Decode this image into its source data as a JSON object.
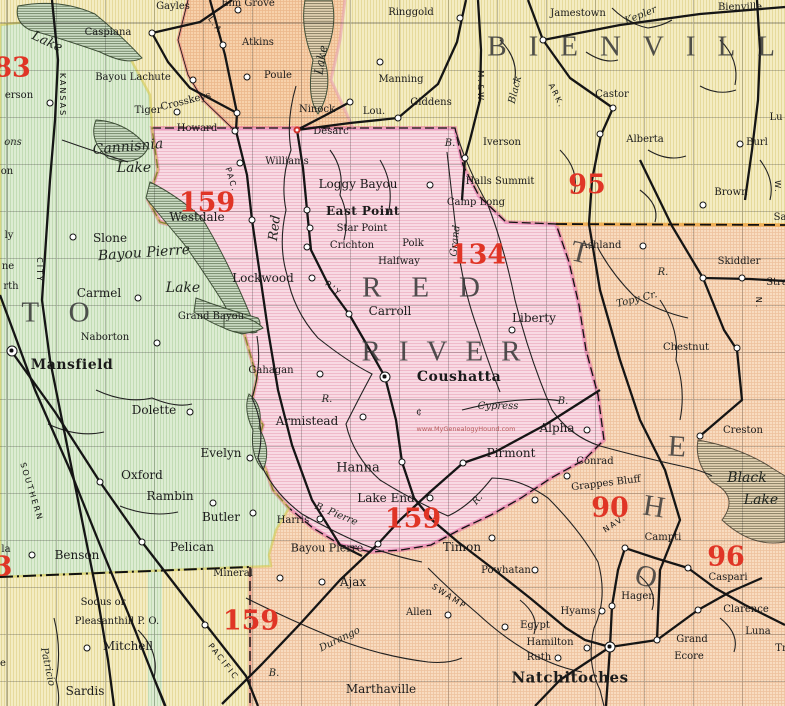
{
  "page": {
    "title": "Red River Parish, Louisiana, 1911, Map"
  },
  "map": {
    "watermark": "www.MyGenealogyHound.com",
    "regions": [
      {
        "id": "west-green",
        "fill": "#dcecd2"
      },
      {
        "id": "center-pink",
        "fill": "#f8dae3"
      },
      {
        "id": "northeast-yellow",
        "fill": "#f4ecc2"
      },
      {
        "id": "southeast-orange",
        "fill": "#f8dcc0"
      },
      {
        "id": "topcenter-orange",
        "fill": "#f7d2ac"
      },
      {
        "id": "topleft-yellow",
        "fill": "#f6eec6"
      },
      {
        "id": "bottomleft-yellow",
        "fill": "#f5ecc0"
      }
    ],
    "accent": {
      "red_numbers": "#e03526",
      "boundary_pink": "#e0559b",
      "boundary_orange": "#eda43e"
    },
    "labels": [
      {
        "t": "Gayles",
        "x": 173,
        "y": 7
      },
      {
        "t": "Caspiana",
        "x": 108,
        "y": 33
      },
      {
        "t": "Bayou Lachute",
        "x": 133,
        "y": 78
      },
      {
        "t": "Tiger",
        "x": 148,
        "y": 111
      },
      {
        "t": "Crosskeys",
        "x": 186,
        "y": 102,
        "r": -14
      },
      {
        "t": "Howard",
        "x": 197,
        "y": 129
      },
      {
        "t": "Elm Grove",
        "x": 248,
        "y": 4
      },
      {
        "t": "Atkins",
        "x": 258,
        "y": 43
      },
      {
        "t": "Poule",
        "x": 278,
        "y": 76
      },
      {
        "t": "Ninock",
        "x": 317,
        "y": 110
      },
      {
        "t": "Lou.",
        "x": 374,
        "y": 112
      },
      {
        "t": "Desarc",
        "x": 331,
        "y": 132
      },
      {
        "t": "Manning",
        "x": 401,
        "y": 80
      },
      {
        "t": "Giddens",
        "x": 431,
        "y": 103
      },
      {
        "t": "Ringgold",
        "x": 411,
        "y": 13
      },
      {
        "t": "Jamestown",
        "x": 578,
        "y": 14
      },
      {
        "t": "Kepler",
        "x": 641,
        "y": 16,
        "c": "wat",
        "r": -22
      },
      {
        "t": "Bienville",
        "x": 740,
        "y": 8
      },
      {
        "t": "BIENVILLE",
        "x": 662,
        "y": 47,
        "c": "big",
        "ls": 22
      },
      {
        "t": "Castor",
        "x": 612,
        "y": 95
      },
      {
        "t": "Alberta",
        "x": 645,
        "y": 140
      },
      {
        "t": "Iverson",
        "x": 502,
        "y": 143
      },
      {
        "t": "Brown",
        "x": 731,
        "y": 193
      },
      {
        "t": "Burl",
        "x": 757,
        "y": 143
      },
      {
        "t": "Lu",
        "x": 776,
        "y": 118
      },
      {
        "t": "Sa",
        "x": 780,
        "y": 218
      },
      {
        "t": "W.",
        "x": 777,
        "y": 187,
        "c": "rr",
        "r": 90
      },
      {
        "t": "95",
        "x": 587,
        "y": 185,
        "c": "num"
      },
      {
        "t": "Halls Summit",
        "x": 500,
        "y": 182
      },
      {
        "t": "Camp Long",
        "x": 476,
        "y": 203
      },
      {
        "t": "Williams",
        "x": 287,
        "y": 162
      },
      {
        "t": "Loggy Bayou",
        "x": 358,
        "y": 184,
        "fs": 12
      },
      {
        "t": "East Point",
        "x": 363,
        "y": 211,
        "c": "tb",
        "fs": 12
      },
      {
        "t": "Star Point",
        "x": 362,
        "y": 229
      },
      {
        "t": "Crichton",
        "x": 352,
        "y": 246
      },
      {
        "t": "Polk",
        "x": 413,
        "y": 244
      },
      {
        "t": "Halfway",
        "x": 399,
        "y": 262
      },
      {
        "t": "Westdale",
        "x": 197,
        "y": 217,
        "fs": 12
      },
      {
        "t": "159",
        "x": 207,
        "y": 203,
        "c": "num"
      },
      {
        "t": "134",
        "x": 478,
        "y": 255,
        "c": "num"
      },
      {
        "t": "Lockwood",
        "x": 263,
        "y": 278,
        "fs": 12
      },
      {
        "t": "Carroll",
        "x": 390,
        "y": 311,
        "fs": 12
      },
      {
        "t": "Liberty",
        "x": 534,
        "y": 318,
        "fs": 12
      },
      {
        "t": "RED",
        "x": 436,
        "y": 288,
        "c": "big",
        "ls": 30
      },
      {
        "t": "RIVER",
        "x": 450,
        "y": 352,
        "c": "big",
        "ls": 18
      },
      {
        "t": "Coushatta",
        "x": 459,
        "y": 377,
        "c": "tb",
        "fs": 14
      },
      {
        "t": "Gahagan",
        "x": 271,
        "y": 371
      },
      {
        "t": "R.",
        "x": 327,
        "y": 400,
        "c": "wat"
      },
      {
        "t": "Armistead",
        "x": 307,
        "y": 421,
        "fs": 12
      },
      {
        "t": "¢",
        "x": 419,
        "y": 413,
        "c": "ts"
      },
      {
        "t": "www.MyGenealogyHound.com",
        "x": 466,
        "y": 429,
        "c": "wm"
      },
      {
        "t": "Cypress",
        "x": 498,
        "y": 407,
        "c": "wat"
      },
      {
        "t": "B.",
        "x": 563,
        "y": 402,
        "c": "wat"
      },
      {
        "t": "Alpha",
        "x": 557,
        "y": 428,
        "fs": 12
      },
      {
        "t": "Hanna",
        "x": 358,
        "y": 468,
        "fs": 13
      },
      {
        "t": "Lake End",
        "x": 386,
        "y": 498,
        "fs": 12
      },
      {
        "t": "159",
        "x": 413,
        "y": 519,
        "c": "num"
      },
      {
        "t": "Pirmont",
        "x": 511,
        "y": 453,
        "fs": 12
      },
      {
        "t": "R.",
        "x": 478,
        "y": 500,
        "c": "wat",
        "r": -50
      },
      {
        "t": "Harris",
        "x": 293,
        "y": 521
      },
      {
        "t": "B. Pierre",
        "x": 336,
        "y": 515,
        "c": "wat",
        "r": 22
      },
      {
        "t": "Bayou Pierre",
        "x": 327,
        "y": 548,
        "fs": 11
      },
      {
        "t": "Timon",
        "x": 462,
        "y": 547,
        "fs": 12
      },
      {
        "t": "Powhatan",
        "x": 506,
        "y": 571
      },
      {
        "t": "Ajax",
        "x": 353,
        "y": 582,
        "fs": 12
      },
      {
        "t": "Allen",
        "x": 419,
        "y": 613
      },
      {
        "t": "SWAMP",
        "x": 449,
        "y": 597,
        "c": "rr",
        "r": 33
      },
      {
        "t": "Durango",
        "x": 340,
        "y": 640,
        "c": "wat",
        "r": -26
      },
      {
        "t": "Marthaville",
        "x": 381,
        "y": 689,
        "fs": 12
      },
      {
        "t": "Ashland",
        "x": 601,
        "y": 246
      },
      {
        "t": "Skiddler",
        "x": 739,
        "y": 262
      },
      {
        "t": "Stra",
        "x": 777,
        "y": 283
      },
      {
        "t": "R.",
        "x": 663,
        "y": 273,
        "c": "wat"
      },
      {
        "t": "Topy Cr.",
        "x": 637,
        "y": 300,
        "c": "wat",
        "r": -14
      },
      {
        "t": "Chestnut",
        "x": 686,
        "y": 348
      },
      {
        "t": "N.",
        "x": 758,
        "y": 303,
        "c": "rr",
        "r": 90
      },
      {
        "t": "Creston",
        "x": 743,
        "y": 431
      },
      {
        "t": "Black",
        "x": 747,
        "y": 478,
        "c": "watl"
      },
      {
        "t": "Lake",
        "x": 761,
        "y": 500,
        "c": "watl"
      },
      {
        "t": "Conrad",
        "x": 595,
        "y": 462
      },
      {
        "t": "Grappes Bluff",
        "x": 606,
        "y": 484,
        "r": -7
      },
      {
        "t": "90",
        "x": 610,
        "y": 508,
        "c": "num"
      },
      {
        "t": "NAV.",
        "x": 615,
        "y": 524,
        "c": "rr",
        "r": -33
      },
      {
        "t": "Campti",
        "x": 663,
        "y": 538
      },
      {
        "t": "96",
        "x": 726,
        "y": 557,
        "c": "num"
      },
      {
        "t": "Caspari",
        "x": 728,
        "y": 578
      },
      {
        "t": "Hagen",
        "x": 638,
        "y": 597
      },
      {
        "t": "Hyams",
        "x": 578,
        "y": 612
      },
      {
        "t": "Egypt",
        "x": 535,
        "y": 626
      },
      {
        "t": "Hamilton",
        "x": 550,
        "y": 643
      },
      {
        "t": "Ruth",
        "x": 539,
        "y": 658
      },
      {
        "t": "Natchitoches",
        "x": 570,
        "y": 678,
        "c": "tb",
        "fs": 15
      },
      {
        "t": "Clarence",
        "x": 746,
        "y": 610
      },
      {
        "t": "Luna",
        "x": 758,
        "y": 632
      },
      {
        "t": "Grand",
        "x": 692,
        "y": 640
      },
      {
        "t": "Ecore",
        "x": 689,
        "y": 657
      },
      {
        "t": "Tr",
        "x": 781,
        "y": 649
      },
      {
        "t": "T",
        "x": 580,
        "y": 253,
        "c": "bigl",
        "r": 14
      },
      {
        "t": "E",
        "x": 677,
        "y": 447,
        "c": "bigl",
        "r": 4
      },
      {
        "t": "H",
        "x": 654,
        "y": 507,
        "c": "bigl",
        "r": 9
      },
      {
        "t": "O",
        "x": 646,
        "y": 577,
        "c": "bigl",
        "r": 14
      },
      {
        "t": "Lake",
        "x": 47,
        "y": 42,
        "c": "wat",
        "r": 25,
        "fs": 13
      },
      {
        "t": "83",
        "x": 12,
        "y": 68,
        "c": "num"
      },
      {
        "t": "erson",
        "x": 19,
        "y": 96
      },
      {
        "t": "KANSAS",
        "x": 62,
        "y": 95,
        "c": "rr",
        "r": 90
      },
      {
        "t": "ons",
        "x": 13,
        "y": 143,
        "c": "wat"
      },
      {
        "t": "Cannisnia",
        "x": 128,
        "y": 147,
        "c": "watl",
        "r": -5
      },
      {
        "t": "Lake",
        "x": 134,
        "y": 168,
        "c": "watl"
      },
      {
        "t": "on",
        "x": 7,
        "y": 172
      },
      {
        "t": "ly",
        "x": 9,
        "y": 236
      },
      {
        "t": "ne",
        "x": 8,
        "y": 267
      },
      {
        "t": "rth",
        "x": 11,
        "y": 287
      },
      {
        "t": "CITY",
        "x": 39,
        "y": 270,
        "c": "rr",
        "r": 90
      },
      {
        "t": "Slone",
        "x": 110,
        "y": 238,
        "fs": 12
      },
      {
        "t": "Bayou Pierre",
        "x": 144,
        "y": 253,
        "c": "watl",
        "r": -4
      },
      {
        "t": "Lake",
        "x": 183,
        "y": 288,
        "c": "watl"
      },
      {
        "t": "Carmel",
        "x": 99,
        "y": 293,
        "fs": 12
      },
      {
        "t": "OTO",
        "x": 45,
        "y": 313,
        "c": "big",
        "ls": 30
      },
      {
        "t": "Grand Bayou",
        "x": 211,
        "y": 317
      },
      {
        "t": "Naborton",
        "x": 105,
        "y": 338
      },
      {
        "t": "Mansfield",
        "x": 72,
        "y": 365,
        "c": "tb",
        "fs": 14
      },
      {
        "t": "Dolette",
        "x": 154,
        "y": 410,
        "fs": 12
      },
      {
        "t": "SOUTHERN",
        "x": 31,
        "y": 492,
        "c": "rr",
        "r": 73
      },
      {
        "t": "Evelyn",
        "x": 221,
        "y": 453,
        "fs": 12
      },
      {
        "t": "Oxford",
        "x": 142,
        "y": 475,
        "fs": 12
      },
      {
        "t": "Rambin",
        "x": 170,
        "y": 496,
        "fs": 12
      },
      {
        "t": "Butler",
        "x": 221,
        "y": 517,
        "fs": 12
      },
      {
        "t": "Pelican",
        "x": 192,
        "y": 547,
        "fs": 12
      },
      {
        "t": "Benson",
        "x": 77,
        "y": 555,
        "fs": 12
      },
      {
        "t": "Mineral",
        "x": 233,
        "y": 574
      },
      {
        "t": "la",
        "x": 6,
        "y": 550
      },
      {
        "t": "3",
        "x": 3,
        "y": 567,
        "c": "num"
      },
      {
        "t": "Sodus or",
        "x": 103,
        "y": 603
      },
      {
        "t": "Pleasanthill P. O.",
        "x": 117,
        "y": 622
      },
      {
        "t": "159",
        "x": 251,
        "y": 621,
        "c": "num"
      },
      {
        "t": "Mitchell",
        "x": 128,
        "y": 646,
        "fs": 12
      },
      {
        "t": "Patricio",
        "x": 47,
        "y": 667,
        "c": "wat",
        "r": 78
      },
      {
        "t": "Sardis",
        "x": 85,
        "y": 691,
        "fs": 12
      },
      {
        "t": "e",
        "x": 3,
        "y": 664
      },
      {
        "t": "PACIFIC",
        "x": 223,
        "y": 662,
        "c": "rr",
        "r": 52
      },
      {
        "t": "B.",
        "x": 274,
        "y": 674,
        "c": "wat"
      },
      {
        "t": "PAC.",
        "x": 231,
        "y": 180,
        "c": "rr",
        "r": 73
      },
      {
        "t": "R'Y",
        "x": 333,
        "y": 289,
        "c": "rr",
        "r": 40
      },
      {
        "t": "Red",
        "x": 275,
        "y": 228,
        "c": "wat",
        "r": -83,
        "fs": 13
      },
      {
        "t": "Lake",
        "x": 321,
        "y": 60,
        "c": "wat",
        "r": -80,
        "fs": 12
      },
      {
        "t": "L.A.",
        "x": 216,
        "y": 27,
        "c": "rr",
        "r": 55
      },
      {
        "t": "Black",
        "x": 516,
        "y": 90,
        "c": "wat",
        "r": -76
      },
      {
        "t": "B.",
        "x": 450,
        "y": 144,
        "c": "wat"
      },
      {
        "t": "ARK.",
        "x": 556,
        "y": 96,
        "c": "rr",
        "r": 64
      },
      {
        "t": "M.&W.",
        "x": 480,
        "y": 88,
        "c": "rr",
        "r": 90
      },
      {
        "t": "Grand",
        "x": 456,
        "y": 241,
        "c": "wat",
        "r": -84
      }
    ],
    "dots": [
      [
        238,
        10
      ],
      [
        152,
        33
      ],
      [
        223,
        45
      ],
      [
        247,
        77
      ],
      [
        193,
        80
      ],
      [
        177,
        112
      ],
      [
        237,
        113
      ],
      [
        235,
        131
      ],
      [
        350,
        102
      ],
      [
        380,
        62
      ],
      [
        398,
        118
      ],
      [
        460,
        18
      ],
      [
        543,
        40
      ],
      [
        613,
        108
      ],
      [
        600,
        134
      ],
      [
        465,
        158
      ],
      [
        703,
        205
      ],
      [
        740,
        144
      ],
      [
        297,
        130,
        "r"
      ],
      [
        240,
        163
      ],
      [
        252,
        220
      ],
      [
        307,
        210
      ],
      [
        310,
        228
      ],
      [
        307,
        247
      ],
      [
        430,
        185
      ],
      [
        312,
        278
      ],
      [
        349,
        314
      ],
      [
        512,
        330
      ],
      [
        385,
        377,
        "s"
      ],
      [
        320,
        374
      ],
      [
        363,
        417
      ],
      [
        587,
        430
      ],
      [
        643,
        246
      ],
      [
        703,
        278
      ],
      [
        742,
        278
      ],
      [
        737,
        348
      ],
      [
        700,
        436
      ],
      [
        567,
        476
      ],
      [
        535,
        500
      ],
      [
        463,
        463
      ],
      [
        402,
        462
      ],
      [
        430,
        498
      ],
      [
        320,
        519
      ],
      [
        378,
        544
      ],
      [
        492,
        538
      ],
      [
        535,
        570
      ],
      [
        322,
        582
      ],
      [
        448,
        615
      ],
      [
        280,
        578
      ],
      [
        50,
        103
      ],
      [
        12,
        351,
        "s"
      ],
      [
        73,
        237
      ],
      [
        138,
        298
      ],
      [
        157,
        343
      ],
      [
        190,
        412
      ],
      [
        250,
        458
      ],
      [
        100,
        482
      ],
      [
        213,
        503
      ],
      [
        253,
        513
      ],
      [
        142,
        542
      ],
      [
        32,
        555
      ],
      [
        205,
        625
      ],
      [
        87,
        648
      ],
      [
        625,
        548
      ],
      [
        688,
        568
      ],
      [
        612,
        606
      ],
      [
        602,
        611
      ],
      [
        505,
        627
      ],
      [
        587,
        648
      ],
      [
        558,
        658
      ],
      [
        610,
        647,
        "s"
      ],
      [
        698,
        610
      ],
      [
        657,
        640
      ]
    ]
  }
}
